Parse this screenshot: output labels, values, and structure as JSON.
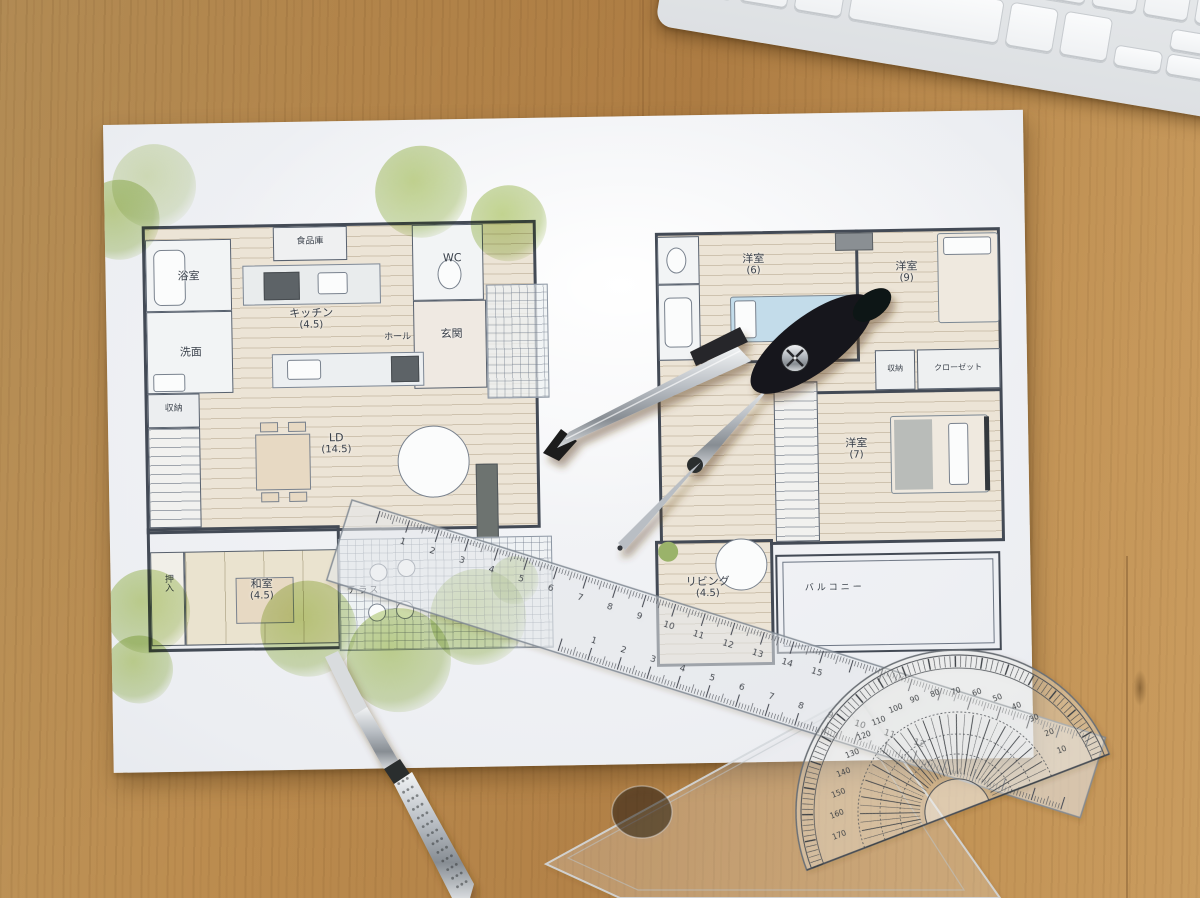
{
  "colors": {
    "wood": "#b5854a",
    "paper": "#f4f5f7",
    "plan_line": "#434a55",
    "tree_green": "#b8cc7e",
    "bed_blue": "#c3dcea"
  },
  "floor_plan_1f": {
    "rooms": {
      "bath": {
        "label": "浴室"
      },
      "washroom": {
        "label": "洗面"
      },
      "pantry": {
        "label": "食品庫"
      },
      "kitchen": {
        "label": "キッチン",
        "size": "(4.5)"
      },
      "wc": {
        "label": "WC"
      },
      "hall": {
        "label": "ホール"
      },
      "entrance": {
        "label": "玄関"
      },
      "storage": {
        "label": "収納"
      },
      "living_dining": {
        "label": "LD",
        "size": "(14.5)"
      },
      "closet": {
        "label": "押入"
      },
      "japanese_room": {
        "label": "和室",
        "size": "(4.5)"
      },
      "terrace": {
        "label": "テラス"
      }
    }
  },
  "floor_plan_2f": {
    "rooms": {
      "bedroom_6": {
        "label": "洋室",
        "size": "(6)"
      },
      "bedroom_9": {
        "label": "洋室",
        "size": "(9)"
      },
      "bedroom_7": {
        "label": "洋室",
        "size": "(7)"
      },
      "storage": {
        "label": "収納"
      },
      "closet": {
        "label": "クローゼット"
      },
      "second_living": {
        "label": "リビング",
        "size": "(4.5)"
      },
      "balcony": {
        "label": "バルコニー"
      }
    }
  },
  "tools": {
    "ruler": {
      "top_numbers": [
        "1",
        "2",
        "3",
        "4",
        "5",
        "6",
        "7",
        "8",
        "9",
        "10",
        "11",
        "12",
        "13",
        "14",
        "15"
      ],
      "bottom_numbers": [
        "1",
        "2",
        "3",
        "4",
        "5",
        "6",
        "7",
        "8",
        "9",
        "10",
        "11",
        "12"
      ]
    },
    "protractor": {
      "degree_labels": [
        "10",
        "20",
        "30",
        "40",
        "50",
        "60",
        "70",
        "80",
        "90",
        "100",
        "110",
        "120",
        "130",
        "140",
        "150",
        "160",
        "170"
      ]
    }
  }
}
